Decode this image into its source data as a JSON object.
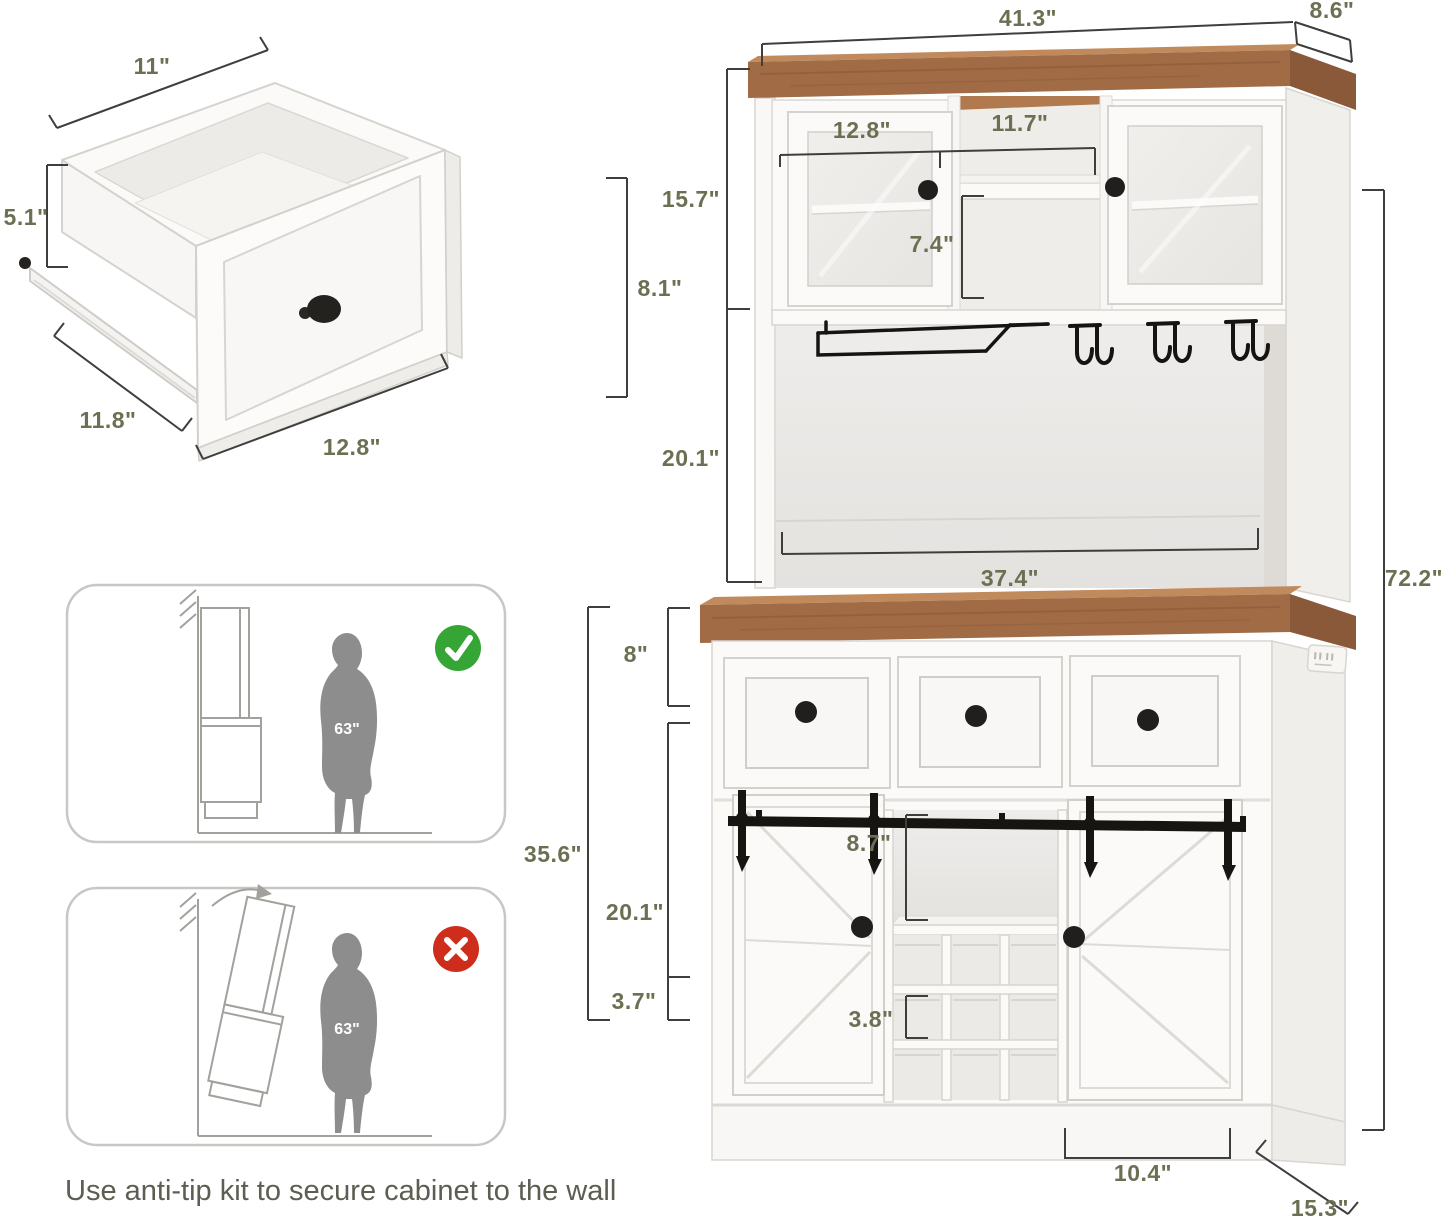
{
  "colors": {
    "background": "#ffffff",
    "dimension_text": "#6b7052",
    "dimension_line": "#3e3e3c",
    "wood": "#a06b45",
    "wood_light": "#c08a5c",
    "wood_dark": "#8a5939",
    "cabinet_white": "#fbfaf9",
    "cabinet_stroke": "#d6d3ce",
    "interior_shade": "#e9e7e4",
    "hardware_black": "#1f1e1c",
    "silhouette_gray": "#8d8d8d",
    "check_green": "#35a535",
    "cross_red": "#ce2d1c",
    "caption_text": "#5b5e50",
    "sketch_line": "#a3a19c"
  },
  "dimensions": {
    "drawer_top_width": "11\"",
    "drawer_side_height": "5.1\"",
    "drawer_front_height": "8.1\"",
    "drawer_depth": "11.8\"",
    "drawer_width": "12.8\"",
    "cabinet_width": "41.3\"",
    "cabinet_top_depth": "8.6\"",
    "hutch_left_compartment_width": "12.8\"",
    "hutch_middle_compartment_width": "11.7\"",
    "hutch_cabinet_height": "15.7\"",
    "hutch_middle_shelf_height": "7.4\"",
    "hutch_open_space_height": "20.1\"",
    "hutch_open_space_width": "37.4\"",
    "total_height": "72.2\"",
    "drawer_section_height": "8\"",
    "lower_cabinet_height": "35.6\"",
    "door_section_height": "20.1\"",
    "base_height": "3.7\"",
    "open_cubby_height": "8.7\"",
    "wine_cubby_height": "3.8\"",
    "base_kick_width": "10.4\"",
    "cabinet_depth": "15.3\""
  },
  "anti_tip": {
    "ok_panel": {
      "person_height": "63\"",
      "badge_icon": "check-icon"
    },
    "tip_panel": {
      "person_height": "63\"",
      "badge_icon": "x-icon"
    },
    "caption": "Use anti-tip kit to secure cabinet to the wall"
  }
}
